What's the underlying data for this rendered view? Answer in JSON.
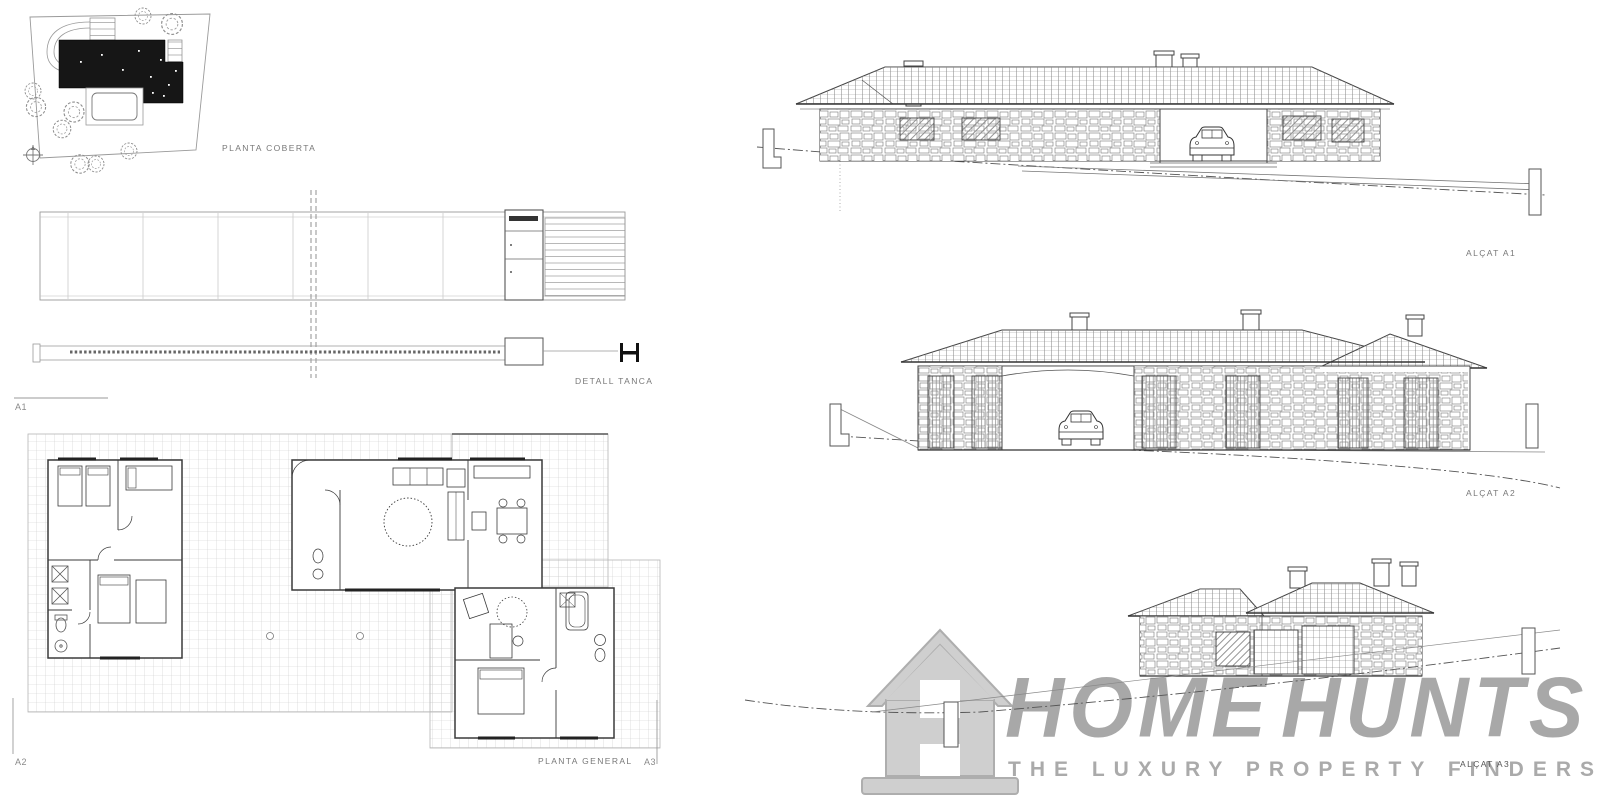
{
  "labels": {
    "roof_plan": "PLANTA COBERTA",
    "fence_detail": "DETALL TANCA",
    "floor_plan": "PLANTA GENERAL",
    "marker_a1": "A1",
    "marker_a2": "A2",
    "marker_a3": "A3",
    "elevation_a1": "ALÇAT A1",
    "elevation_a2": "ALÇAT A2",
    "elevation_a3": "ALÇAT A3"
  },
  "watermark": {
    "brand_part1": "HOME",
    "brand_part2": "HUNTS",
    "tagline": "THE LUXURY PROPERTY FINDERS",
    "text_color": "#9c9c9c",
    "icon_color": "#c9c9c9"
  },
  "colors": {
    "drawing_line": "#555555",
    "light_line": "#9a9a9a",
    "dark_roof_fill": "#161616",
    "terrace_grid": "#c9c9c9",
    "background": "#ffffff"
  }
}
